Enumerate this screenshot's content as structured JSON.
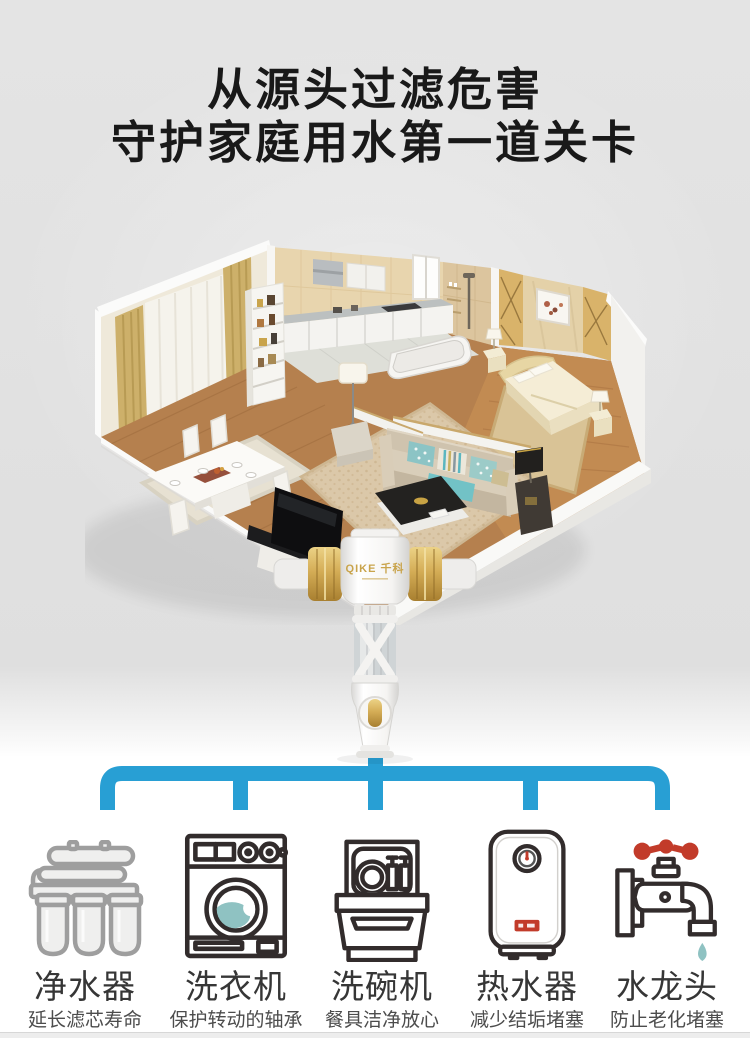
{
  "title": {
    "line1": "从源头过滤危害",
    "line2": "守护家庭用水第一道关卡"
  },
  "product": {
    "brand": "QIKE 千科"
  },
  "appliances": [
    {
      "name": "净水器",
      "desc": "延长滤芯寿命",
      "icon": "water-purifier-icon"
    },
    {
      "name": "洗衣机",
      "desc": "保护转动的轴承",
      "icon": "washing-machine-icon"
    },
    {
      "name": "洗碗机",
      "desc": "餐具洁净放心",
      "icon": "dishwasher-icon"
    },
    {
      "name": "热水器",
      "desc": "减少结垢堵塞",
      "icon": "water-heater-icon"
    },
    {
      "name": "水龙头",
      "desc": "防止老化堵塞",
      "icon": "faucet-icon"
    }
  ],
  "colors": {
    "connector_blue": "#289fd4",
    "icon_dark": "#322c2c",
    "icon_gray": "#9e9e9e",
    "accent_red": "#c23b2a",
    "accent_teal": "#8fc2c2",
    "brand_gold": "#c9a44c",
    "title_color": "#191919",
    "label_color": "#363636",
    "desc_color": "#4c4c4c",
    "bg_gray": "#e2e2e2"
  }
}
